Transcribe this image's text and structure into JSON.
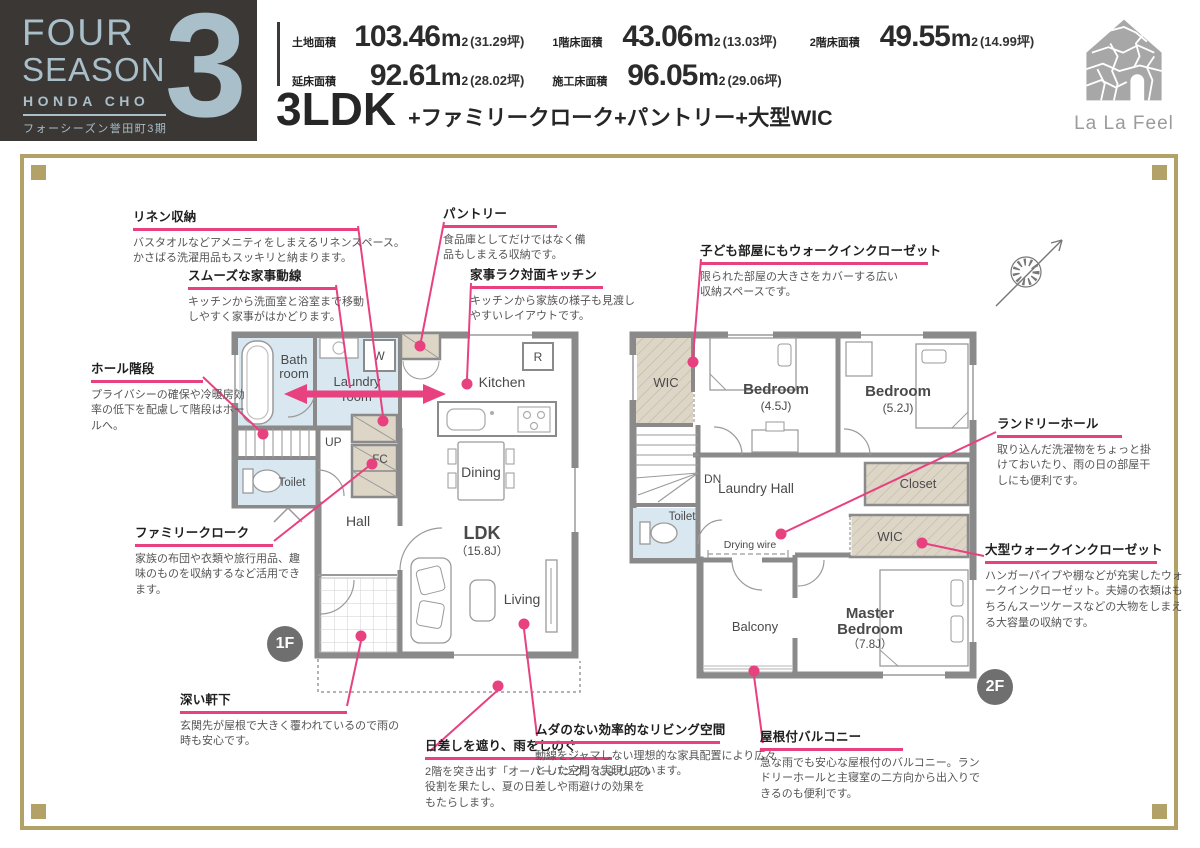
{
  "header": {
    "logo": {
      "line1": "FOUR",
      "line2": "SEASON",
      "line3": "HONDA CHO",
      "subtitle": "フォーシーズン誉田町3期",
      "phase_number": "3"
    },
    "areas": [
      {
        "label": "土地面積",
        "value": "103.46",
        "unit_base": "m",
        "unit_sup": "2",
        "tsubo": "(31.29坪)"
      },
      {
        "label": "延床面積",
        "value": "92.61",
        "unit_base": "m",
        "unit_sup": "2",
        "tsubo": "(28.02坪)"
      },
      {
        "label": "1階床面積",
        "value": "43.06",
        "unit_base": "m",
        "unit_sup": "2",
        "tsubo": "(13.03坪)"
      },
      {
        "label": "施工床面積",
        "value": "96.05",
        "unit_base": "m",
        "unit_sup": "2",
        "tsubo": "(29.06坪)"
      },
      {
        "label": "2階床面積",
        "value": "49.55",
        "unit_base": "m",
        "unit_sup": "2",
        "tsubo": "(14.99坪)"
      }
    ],
    "plan_type": "3LDK",
    "plan_features": "+ファミリークローク+パントリー+大型WIC",
    "brand": "La La Feel"
  },
  "floor1": {
    "badge": "1F",
    "rooms": {
      "bath_l1": "Bath",
      "bath_l2": "room",
      "laundry_l1": "Laundry",
      "laundry_l2": "room",
      "w": "W",
      "kitchen": "Kitchen",
      "r": "R",
      "up": "UP",
      "toilet": "Toilet",
      "fc": "FC",
      "hall": "Hall",
      "dining": "Dining",
      "ldk": "LDK",
      "ldk_size": "（15.8J）",
      "living": "Living"
    }
  },
  "floor2": {
    "badge": "2F",
    "rooms": {
      "wic": "WIC",
      "bedroom1": "Bedroom",
      "bedroom1_size": "(4.5J)",
      "bedroom2": "Bedroom",
      "bedroom2_size": "(5.2J)",
      "dn": "DN",
      "laundry_hall": "Laundry Hall",
      "toilet": "Toilet",
      "closet": "Closet",
      "wic2": "WIC",
      "drying_wire": "Drying wire",
      "balcony": "Balcony",
      "master_l1": "Master",
      "master_l2": "Bedroom",
      "master_size": "（7.8J）"
    }
  },
  "annotations": [
    {
      "title": "リネン収納",
      "body": "バスタオルなどアメニティをしまえるリネンスペース。かさばる洗濯用品もスッキリと納まります。"
    },
    {
      "title": "スムーズな家事動線",
      "body": "キッチンから洗面室と浴室まで移動しやすく家事がはかどります。"
    },
    {
      "title": "ホール階段",
      "body": "プライバシーの確保や冷暖房効率の低下を配慮して階段はホールへ。"
    },
    {
      "title": "ファミリークローク",
      "body": "家族の布団や衣類や旅行用品、趣味のものを収納するなど活用できます。"
    },
    {
      "title": "深い軒下",
      "body": "玄関先が屋根で大きく覆われているので雨の時も安心です。"
    },
    {
      "title": "日差しを遮り、雨をしのぐ",
      "body": "2階を突き出す「オーバーハング」により庇の役割を果たし、夏の日差しや雨避けの効果をもたらします。"
    },
    {
      "title": "パントリー",
      "body": "食品庫としてだけではなく備品もしまえる収納です。"
    },
    {
      "title": "家事ラク対面キッチン",
      "body": "キッチンから家族の様子も見渡しやすいレイアウトです。"
    },
    {
      "title": "ムダのない効率的なリビング空間",
      "body": "動線をジャマしない理想的な家具配置により広々とした空間を実現しています。"
    },
    {
      "title": "子ども部屋にもウォークインクローゼット",
      "body": "限られた部屋の大きさをカバーする広い収納スペースです。"
    },
    {
      "title": "ランドリーホール",
      "body": "取り込んだ洗濯物をちょっと掛けておいたり、雨の日の部屋干しにも便利です。"
    },
    {
      "title": "大型ウォークインクローゼット",
      "body": "ハンガーパイプや棚などが充実したウォークインクローゼット。夫婦の衣類はもちろんスーツケースなどの大物をしまえる大容量の収納です。"
    },
    {
      "title": "屋根付バルコニー",
      "body": "急な雨でも安心な屋根付のバルコニー。ランドリーホールと主寝室の二方向から出入りできるのも便利です。"
    }
  ],
  "colors": {
    "accent_pink": "#e8417f",
    "frame_gold": "#b2a268",
    "logo_bg": "#3b3734",
    "logo_text": "#a9bfc9",
    "wall_gray": "#8a8a8a",
    "wet_room_blue": "#d9e7f0",
    "closet_beige": "#ddd6c7"
  }
}
